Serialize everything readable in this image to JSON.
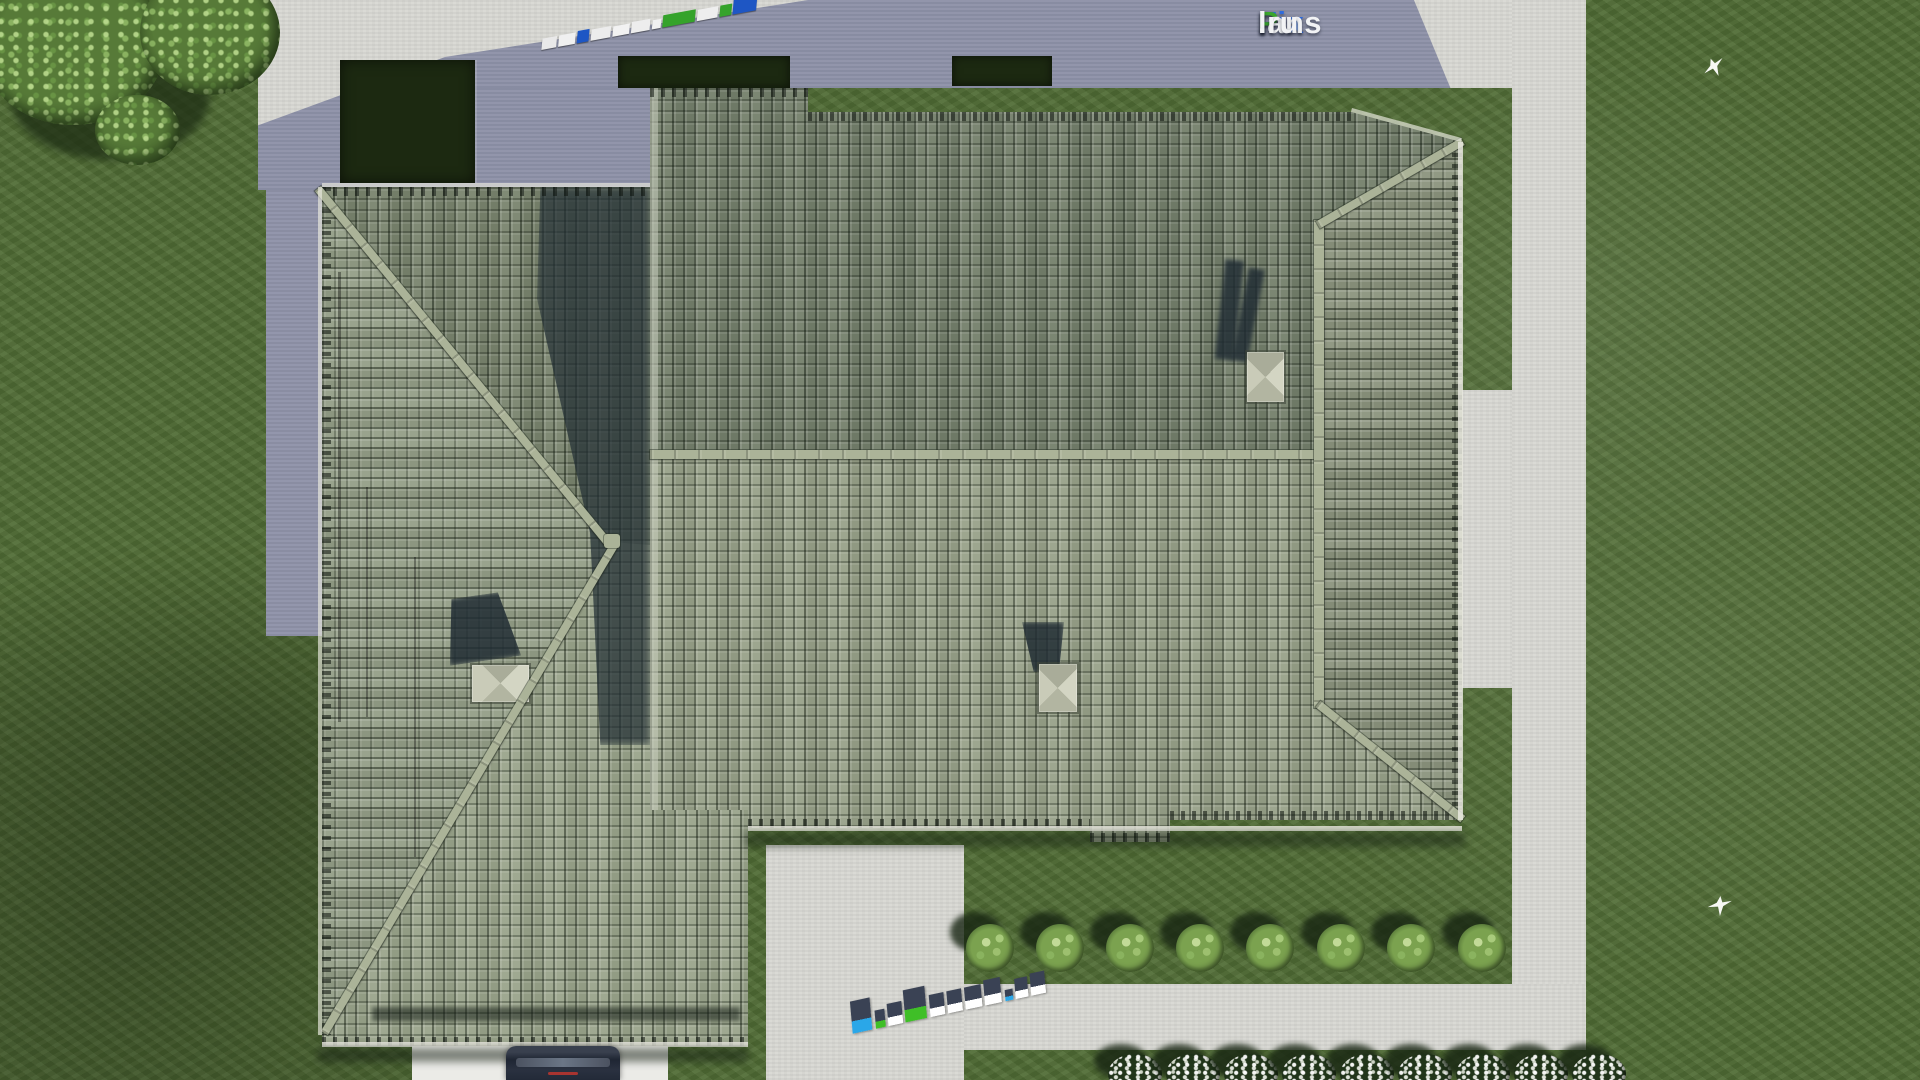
{
  "brand": {
    "name": "FixPlans.ru",
    "part_fix": "Fix",
    "part_p": "P",
    "part_lans": "lans",
    "part_dotru": ".ru",
    "color_fix": "#2f6bdc",
    "color_p": "#3aa62c",
    "color_rest": "#f2f3f5"
  },
  "palette": {
    "grass": "#4f6b34",
    "concrete": "#d8d8d3",
    "concrete_shadow": "#8e92a8",
    "roof_north": "#747f6b",
    "roof_south": "#98a189",
    "roof_east": "#8b947d",
    "wing_west": "#949e87",
    "wing_north": "#79846e",
    "wing_south": "#9aa48b",
    "ridge": "#abb398",
    "hedge": "#1c2911",
    "chimney_cap": "#c7c9b6",
    "cast_shadow": "#27343a",
    "car_body": "#1f2633"
  },
  "scene": {
    "type": "top-down 3d render of hip-roofed house with tiled roof, lawn, concrete paths",
    "birds": [
      {
        "x": 1703,
        "y": 58
      },
      {
        "x": 1708,
        "y": 896
      }
    ],
    "chimneys": 3
  },
  "landscape": {
    "bush_row": {
      "y": 948,
      "x_centers": [
        990,
        1060,
        1130,
        1200,
        1270,
        1341,
        1411,
        1482
      ],
      "radius": 24
    },
    "flower_shrub_row": {
      "y": 1074,
      "x_centers": [
        1135,
        1193,
        1251,
        1309,
        1367,
        1425,
        1483,
        1541,
        1599
      ],
      "rx": 27,
      "ry": 20
    }
  },
  "watermarks": {
    "top": {
      "text": "FixPlans.ru",
      "x": 540,
      "y": 34,
      "angle": -10.5,
      "blocks": [
        {
          "w": 15,
          "h": 11,
          "c": "#e9e9e9"
        },
        {
          "w": 17,
          "h": 11,
          "c": "#f0f0f0"
        },
        {
          "w": 12,
          "h": 12,
          "c": "#1e56c4"
        },
        {
          "w": 20,
          "h": 11,
          "c": "#ececec"
        },
        {
          "w": 17,
          "h": 10,
          "c": "#f2f2f2"
        },
        {
          "w": 19,
          "h": 11,
          "c": "#ededed"
        },
        {
          "w": 9,
          "h": 9,
          "c": "#f0f0f0"
        },
        {
          "w": 33,
          "h": 12,
          "c": "#35a32b"
        },
        {
          "w": 21,
          "h": 11,
          "c": "#eeeeee"
        },
        {
          "w": 12,
          "h": 11,
          "c": "#35a32b"
        },
        {
          "w": 24,
          "h": 16,
          "c": "#1e56c4"
        }
      ]
    },
    "bottom": {
      "text": "FixPlans.ru",
      "x": 848,
      "y": 1002,
      "angle": -12,
      "top_face": "#3a4254",
      "blocks": [
        {
          "w": 20,
          "h": 32,
          "f": "#2aa7e8"
        },
        {
          "w": 10,
          "h": 18,
          "f": "#3fbf27"
        },
        {
          "w": 15,
          "h": 22,
          "f": "#ffffff"
        },
        {
          "w": 22,
          "h": 32,
          "f": "#3fbf27"
        },
        {
          "w": 15,
          "h": 22,
          "f": "#ffffff"
        },
        {
          "w": 15,
          "h": 22,
          "f": "#ffffff"
        },
        {
          "w": 17,
          "h": 22,
          "f": "#ffffff"
        },
        {
          "w": 17,
          "h": 25,
          "f": "#ffffff"
        },
        {
          "w": 8,
          "h": 11,
          "f": "#2aa7e8"
        },
        {
          "w": 13,
          "h": 20,
          "f": "#ffffff"
        },
        {
          "w": 15,
          "h": 22,
          "f": "#ffffff"
        }
      ]
    }
  }
}
